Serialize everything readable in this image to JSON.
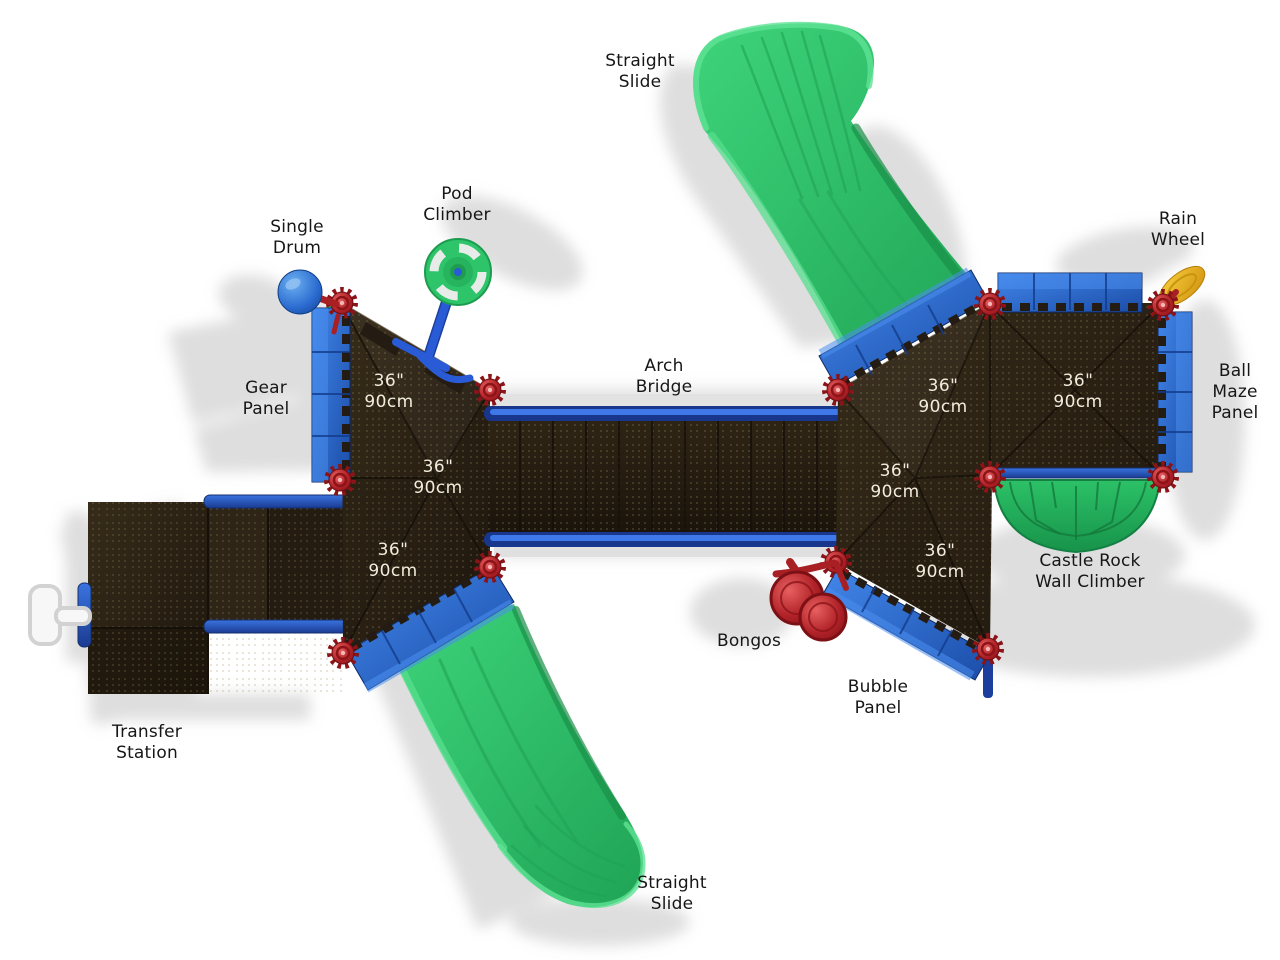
{
  "colors": {
    "background": "#ffffff",
    "slide_green": "#2fc468",
    "panel_blue": "#2a6ad0",
    "rail_blue": "#1c3f9e",
    "deck_brown": "#2a2113",
    "connector_red": "#b5252b",
    "wheel_yellow": "#eebb2a",
    "label_text": "#161616",
    "deck_label_text": "#f2ecdc"
  },
  "equipment_labels": [
    {
      "id": "straight-slide-top",
      "text": "Straight\nSlide"
    },
    {
      "id": "pod-climber",
      "text": "Pod\nClimber"
    },
    {
      "id": "single-drum",
      "text": "Single\nDrum"
    },
    {
      "id": "rain-wheel",
      "text": "Rain\nWheel"
    },
    {
      "id": "gear-panel",
      "text": "Gear\nPanel"
    },
    {
      "id": "arch-bridge",
      "text": "Arch\nBridge"
    },
    {
      "id": "ball-maze-panel",
      "text": "Ball\nMaze\nPanel"
    },
    {
      "id": "castle-rock-wall-climber",
      "text": "Castle Rock\nWall Climber"
    },
    {
      "id": "bongos",
      "text": "Bongos"
    },
    {
      "id": "bubble-panel",
      "text": "Bubble\nPanel"
    },
    {
      "id": "transfer-station",
      "text": "Transfer\nStation"
    },
    {
      "id": "straight-slide-bottom",
      "text": "Straight\nSlide"
    }
  ],
  "deck_height_labels": [
    {
      "text": "36\"\n90cm"
    },
    {
      "text": "36\"\n90cm"
    },
    {
      "text": "36\"\n90cm"
    },
    {
      "text": "36\"\n90cm"
    },
    {
      "text": "36\"\n90cm"
    },
    {
      "text": "36\"\n90cm"
    },
    {
      "text": "36\"\n90cm"
    }
  ]
}
